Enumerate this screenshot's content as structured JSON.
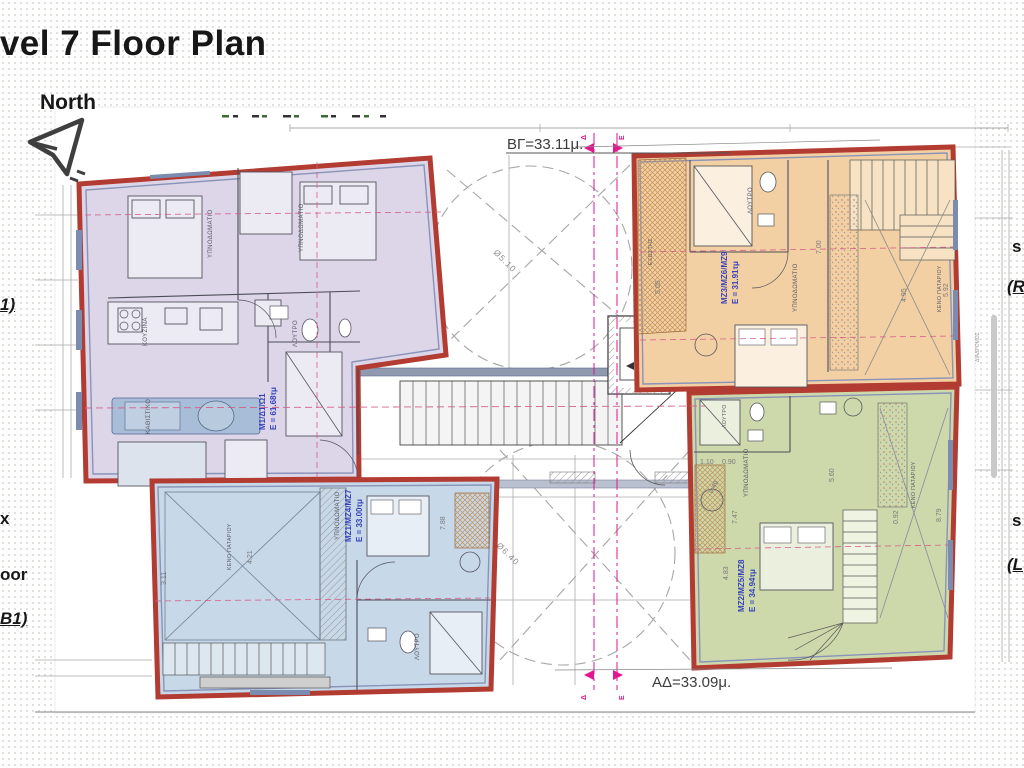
{
  "slide": {
    "title": "Level 7 Floor Plan",
    "north_label": "North"
  },
  "edge_text": {
    "left_fragment_1": "1)",
    "left_fragment_2": "x",
    "left_fragment_3": "oor",
    "left_fragment_4": "B1)",
    "right_fragment_1": "s",
    "right_fragment_2": "(R",
    "right_fragment_3": "s",
    "right_fragment_4": "(L"
  },
  "plan": {
    "dim_top": "ΒΓ=33.11μ.",
    "dim_bottom": "ΑΔ=33.09μ.",
    "section_marker_d": "Δ",
    "section_marker_e": "Ε",
    "circle_top": "Ø5.10",
    "circle_bottom": "Ø6.40",
    "corridor_label": "ΔΙΑΔΡΟΜΟΣ",
    "units": [
      {
        "name": "top-left-unit",
        "fill": "#dcd6e8",
        "code": "Μ1/Δ1/Ω1",
        "area": "Ε = 61.68τμ",
        "rooms": [
          "ΥΠΝΟΔΩΜΑΤΙΟ",
          "ΥΠΝΟΔΩΜΑΤΙΟ",
          "ΚΟΥΖΙΝΑ",
          "ΚΑΘΙΣΤΙΚΟ",
          "ΛΟΥΤΡΟ"
        ],
        "dims": []
      },
      {
        "name": "top-right-unit",
        "fill": "#f3d0a3",
        "code": "ΜΖ3/ΜΖ6/ΜΖ9",
        "area": "Ε = 31.91τμ",
        "rooms": [
          "ΛΟΥΤΡΟ",
          "ΥΠΝΟΔΩΜΑΤΙΟ",
          "ΚΕΝΟ ΠΑΤΑΡΙΟΥ",
          "ΕΞΩΣΤΗΣ"
        ],
        "dims": [
          "4.95",
          "5.92",
          "5.05",
          "7.00"
        ]
      },
      {
        "name": "bottom-left-unit",
        "fill": "#c7d8e9",
        "code": "ΜΖ1/ΜΖ4/ΜΖ7",
        "area": "Ε = 33.00τμ",
        "rooms": [
          "ΚΕΝΟ ΠΑΤΑΡΙΟΥ",
          "ΥΠΝΟΔΩΜΑΤΙΟ",
          "ΛΟΥΤΡΟ"
        ],
        "dims": [
          "4.21",
          "7.88",
          "3.11"
        ]
      },
      {
        "name": "bottom-right-unit",
        "fill": "#cdd9ab",
        "code": "ΜΖ2/ΜΖ5/ΜΖ8",
        "area": "Ε = 34.94τμ",
        "rooms": [
          "ΛΟΥΤΡΟ",
          "ΥΠΝΟΔΩΜΑΤΙΟ",
          "ΚΕΝΟ ΠΑΤΑΡΙΟΥ"
        ],
        "dims": [
          "5.60",
          "8.79",
          "0.92",
          "7.47",
          "4.83",
          "1.10",
          "0.90",
          "0.49"
        ]
      }
    ],
    "colors": {
      "outline_red": "#b23b32",
      "label_blue": "#3642bb",
      "magenta": "#e2168f",
      "wall_gray": "#4d4d57",
      "line_gray": "#9b9b9b"
    }
  }
}
